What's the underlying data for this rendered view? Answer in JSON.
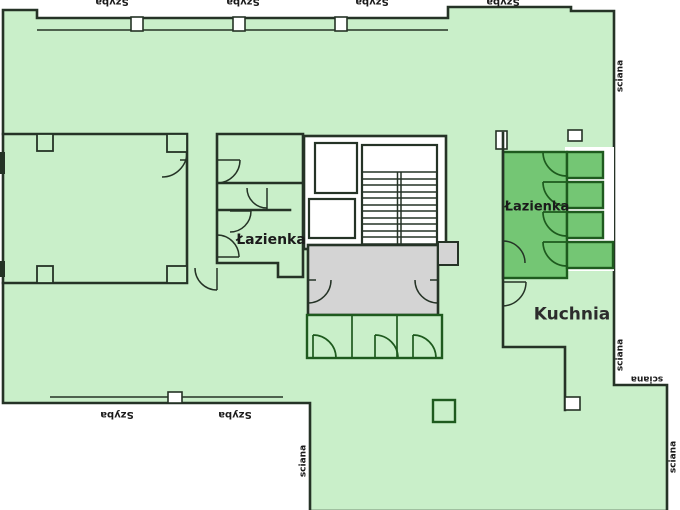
{
  "palette": {
    "floor": "#c9efc9",
    "room_dark": "#74c674",
    "lobby_gray": "#d4d4d4",
    "wall_dark": "#253326",
    "wall_green": "#1e5a1e",
    "label": "#1b1b1b"
  },
  "labels": {
    "bathroom_left": "Łazienka",
    "bathroom_right": "Łazienka",
    "kitchen": "Kuchnia",
    "glass": "Szyba",
    "wall": "sciana"
  },
  "rooms": [
    {
      "name": "Łazienka",
      "type": "bathroom-left"
    },
    {
      "name": "Łazienka",
      "type": "bathroom-right"
    },
    {
      "name": "Kuchnia",
      "type": "kitchen"
    }
  ]
}
